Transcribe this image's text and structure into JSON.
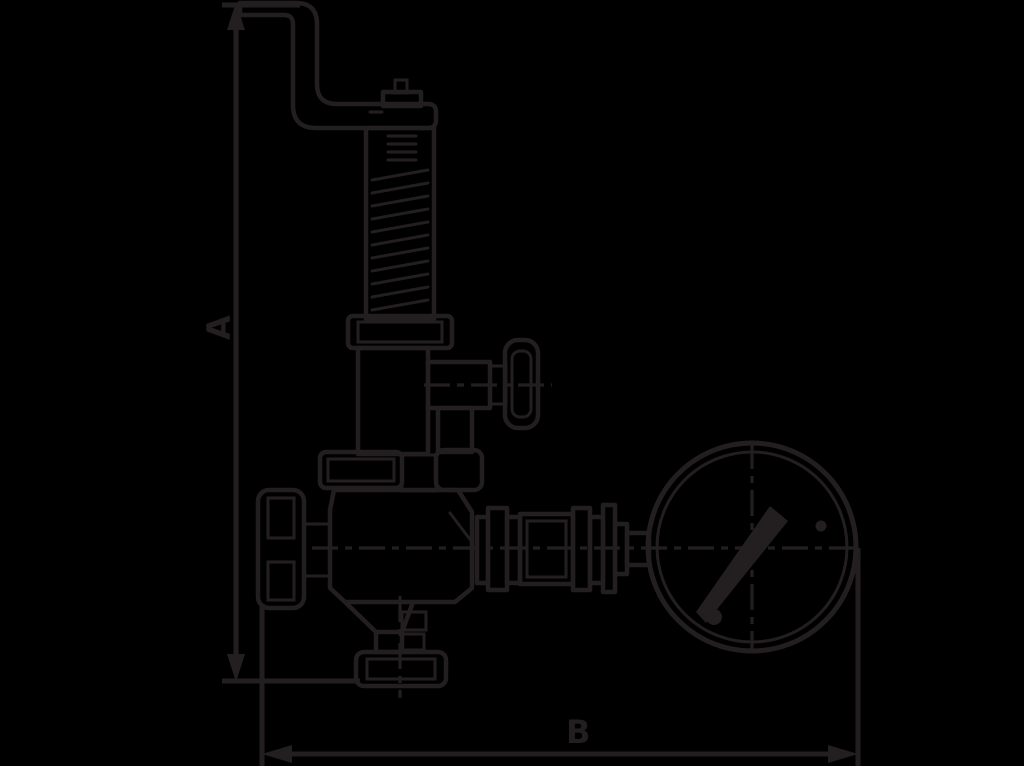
{
  "canvas": {
    "background_color": "#000000",
    "line_color": "#231f20",
    "width": 1024,
    "height": 766
  },
  "diagram": {
    "type": "technical-outline-drawing",
    "subject": "safety-valve-with-lever-and-pressure-gauge",
    "dimension_a": {
      "label": "A",
      "orientation": "vertical",
      "arrow_style": "filled-triangle"
    },
    "dimension_b": {
      "label": "B",
      "orientation": "horizontal",
      "arrow_style": "filled-triangle"
    },
    "components": [
      "lifting-lever",
      "spindle-nut",
      "spring-housing",
      "spring-coils",
      "bonnet",
      "test-connection-knob",
      "side-nozzle",
      "body-flange",
      "handwheel",
      "valve-body",
      "outlet-piping",
      "pressure-gauge",
      "gauge-needle",
      "bottom-outlet-flange"
    ]
  }
}
